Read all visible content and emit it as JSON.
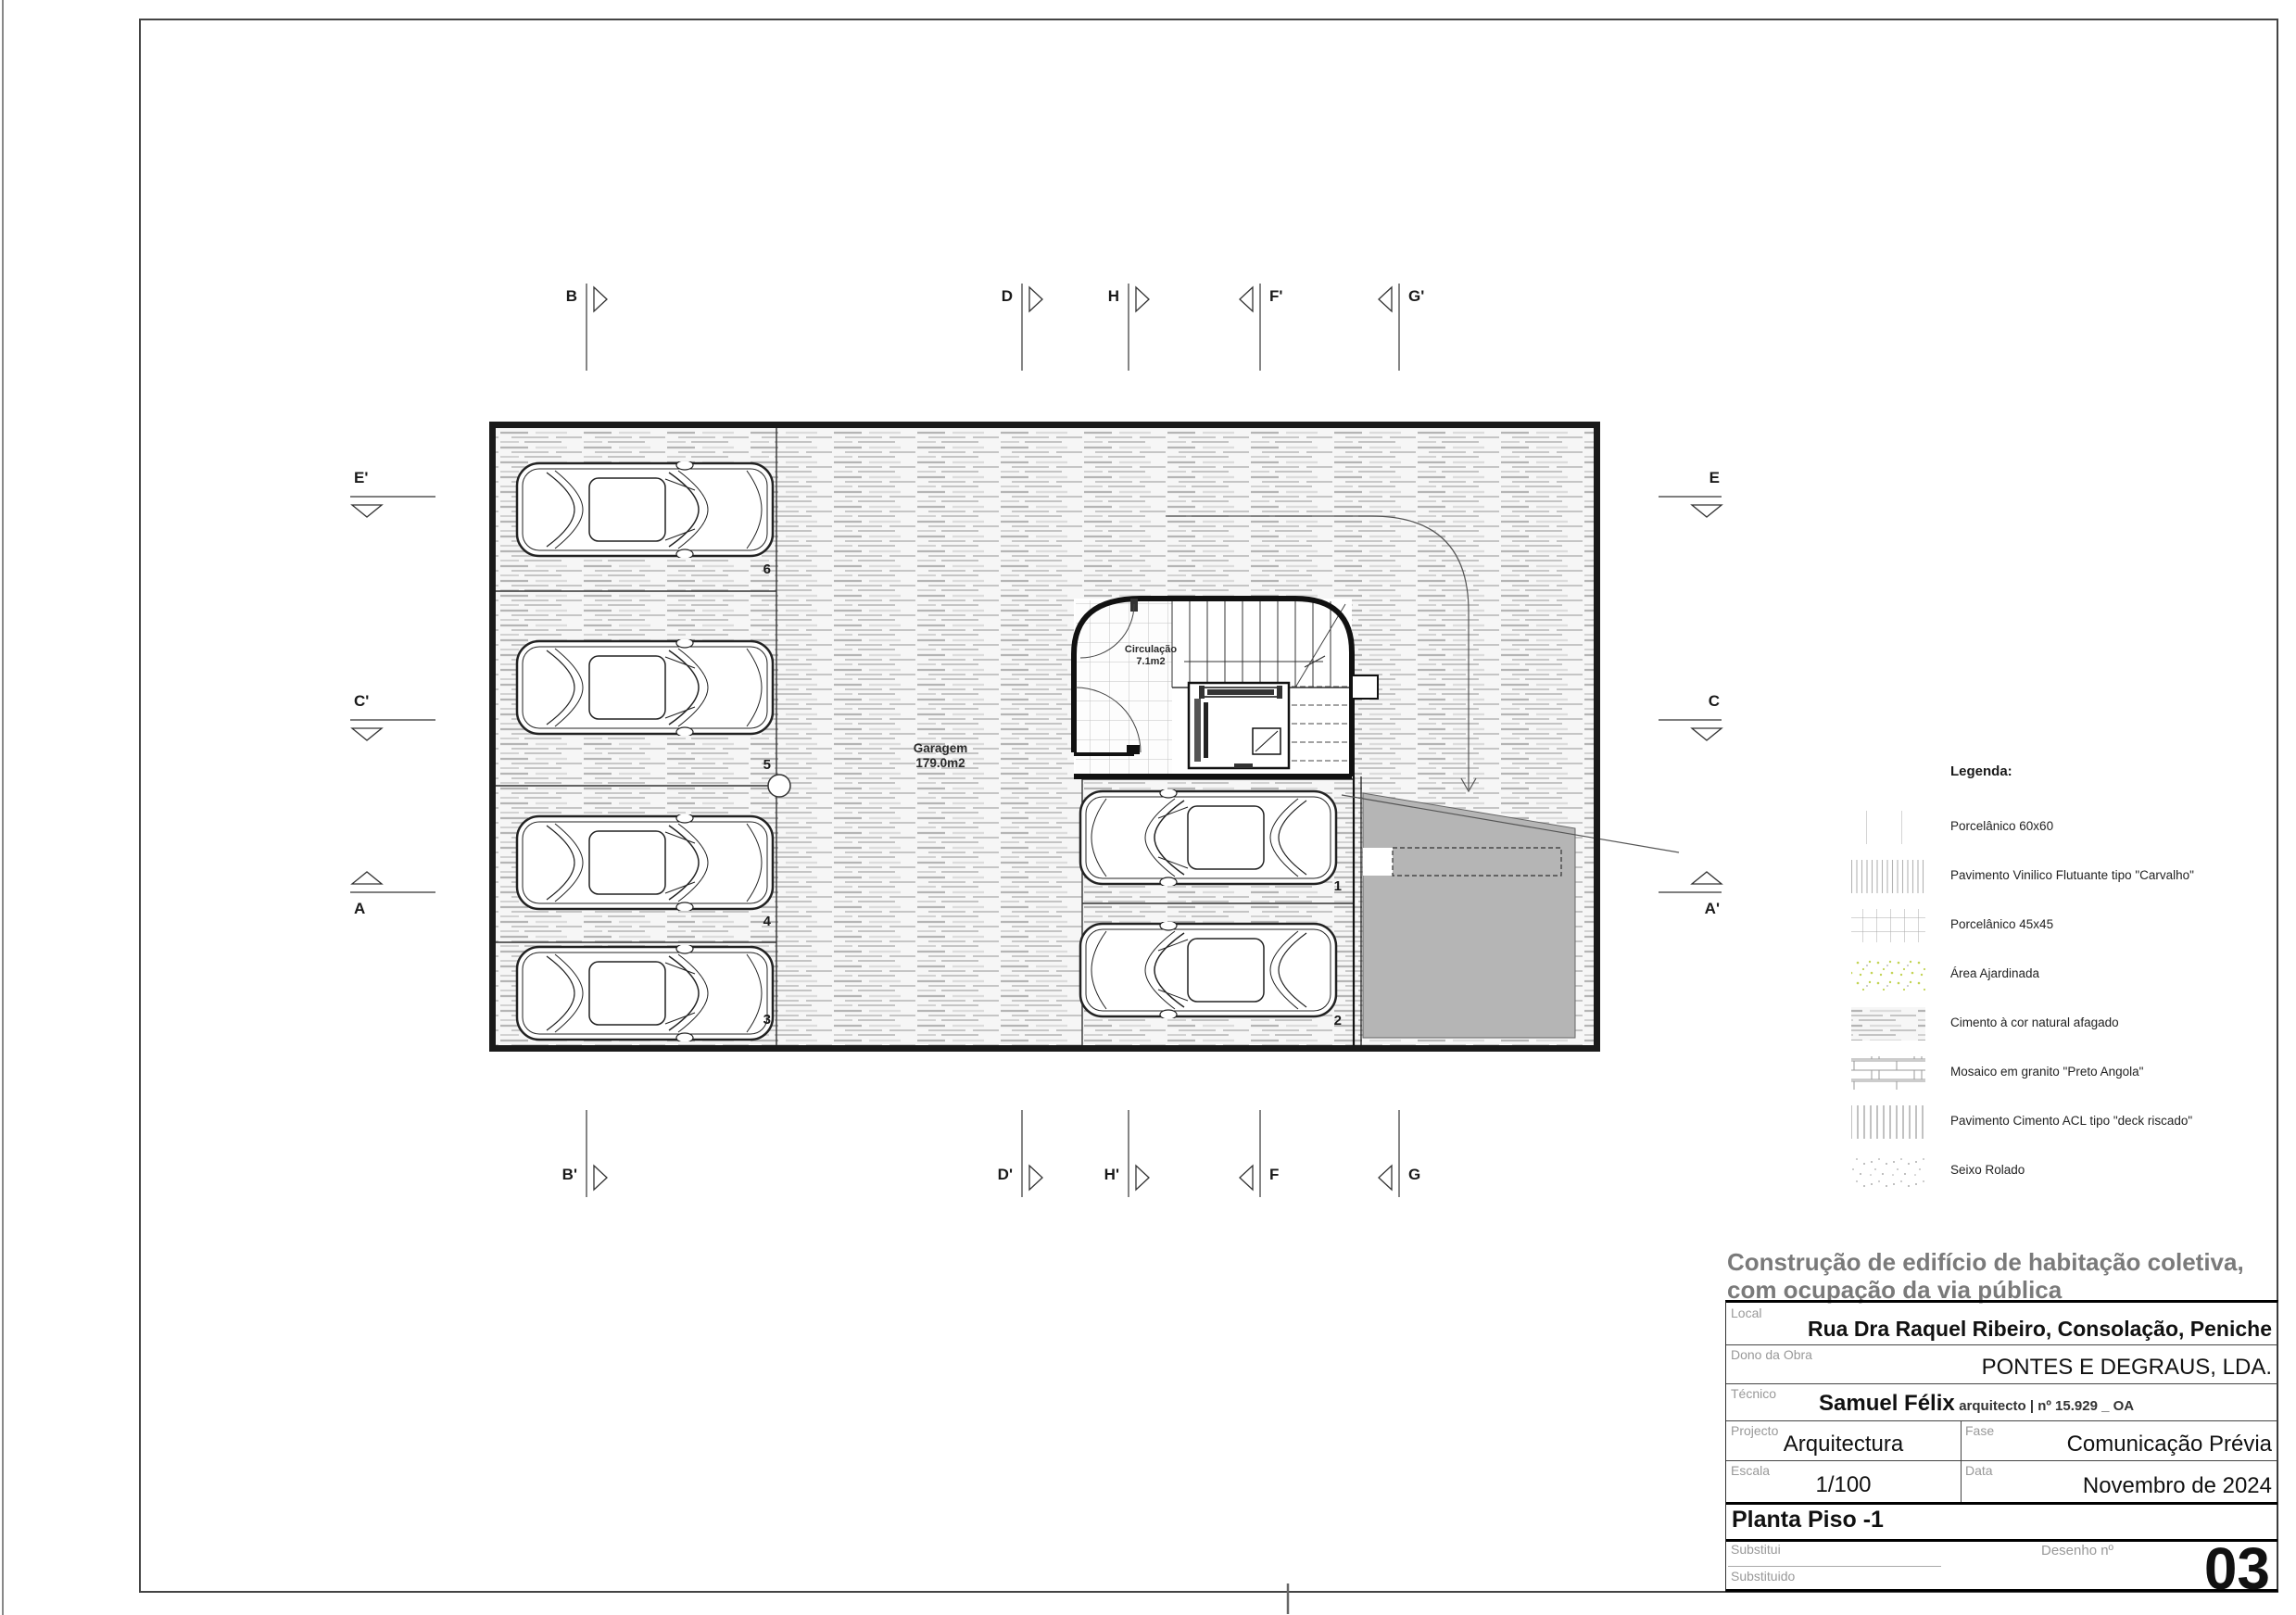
{
  "plan": {
    "rooms": {
      "garage_name": "Garagem",
      "garage_area": "179.0m2",
      "circulation_name": "Circulação",
      "circulation_area": "7.1m2"
    },
    "stalls": [
      "6",
      "5",
      "4",
      "3",
      "1",
      "2"
    ],
    "section_markers": {
      "top": [
        "B",
        "D",
        "H",
        "F'",
        "G'"
      ],
      "bottom": [
        "B'",
        "D'",
        "H'",
        "F",
        "G"
      ],
      "left": [
        "E'",
        "C'",
        "A"
      ],
      "right": [
        "E",
        "C",
        "A'"
      ]
    }
  },
  "legend": {
    "title": "Legenda:",
    "items": [
      {
        "label": "Porcelânico 60x60",
        "pattern": "grid60"
      },
      {
        "label": "Pavimento Vinilico Flutuante tipo \"Carvalho\"",
        "pattern": "vlines"
      },
      {
        "label": "Porcelânico 45x45",
        "pattern": "grid45"
      },
      {
        "label": "Área Ajardinada",
        "pattern": "garden"
      },
      {
        "label": "Cimento à cor natural afagado",
        "pattern": "cement"
      },
      {
        "label": "Mosaico em granito \"Preto Angola\"",
        "pattern": "mosaic"
      },
      {
        "label": "Pavimento Cimento ACL tipo \"deck riscado\"",
        "pattern": "deck"
      },
      {
        "label": "Seixo Rolado",
        "pattern": "pebble"
      }
    ]
  },
  "title_block": {
    "project_title_line1": "Construção de edifício de habitação coletiva,",
    "project_title_line2": "com ocupação da via pública",
    "local_label": "Local",
    "local_value": "Rua Dra Raquel Ribeiro, Consolação, Peniche",
    "owner_label": "Dono da Obra",
    "owner_value": "PONTES E DEGRAUS, LDA.",
    "technician_label": "Técnico",
    "technician_name": "Samuel Félix",
    "technician_credentials": "arquitecto | nº 15.929 _ OA",
    "project_label": "Projecto",
    "project_value": "Arquitectura",
    "phase_label": "Fase",
    "phase_value": "Comunicação Prévia",
    "scale_label": "Escala",
    "scale_value": "1/100",
    "date_label": "Data",
    "date_value": "Novembro de 2024",
    "drawing_name": "Planta Piso -1",
    "replaces_label": "Substitui",
    "replaced_label": "Substituido",
    "drawing_no_label": "Desenho nº",
    "drawing_no_value": "03"
  },
  "colors": {
    "ramp_gray": "#b5b5b5",
    "garden_green": "#c3d455",
    "wall_black": "#1a1a1a"
  }
}
